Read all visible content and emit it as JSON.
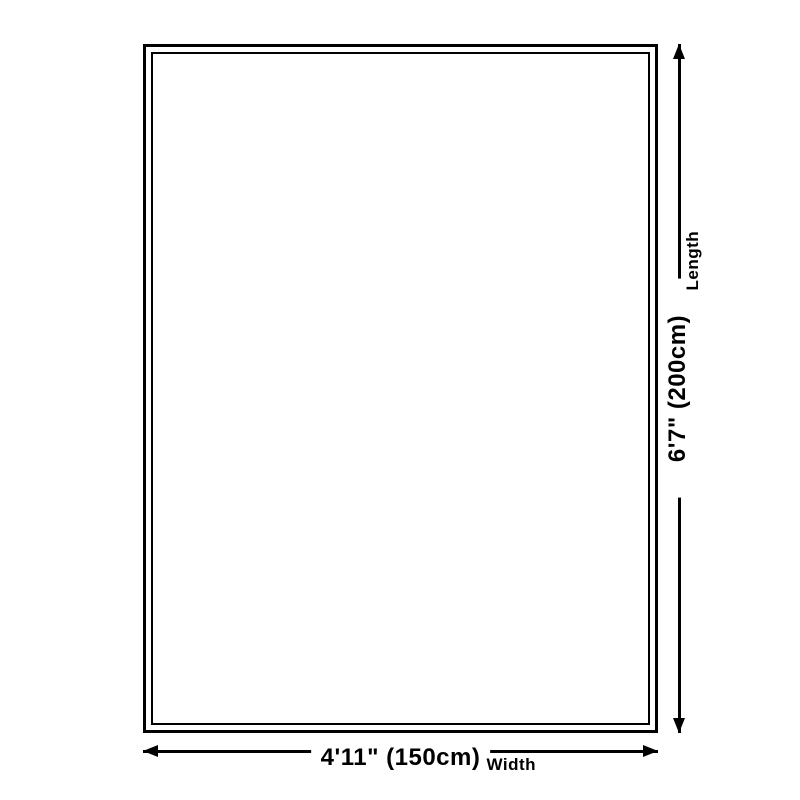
{
  "page": {
    "background": "#ffffff",
    "ink": "#000000"
  },
  "rug_diagram": {
    "length_dimension": {
      "value": "6'7\" (200cm)",
      "label": "Length"
    },
    "width_dimension": {
      "value": "4'11\" (150cm)",
      "label": "Width"
    }
  }
}
